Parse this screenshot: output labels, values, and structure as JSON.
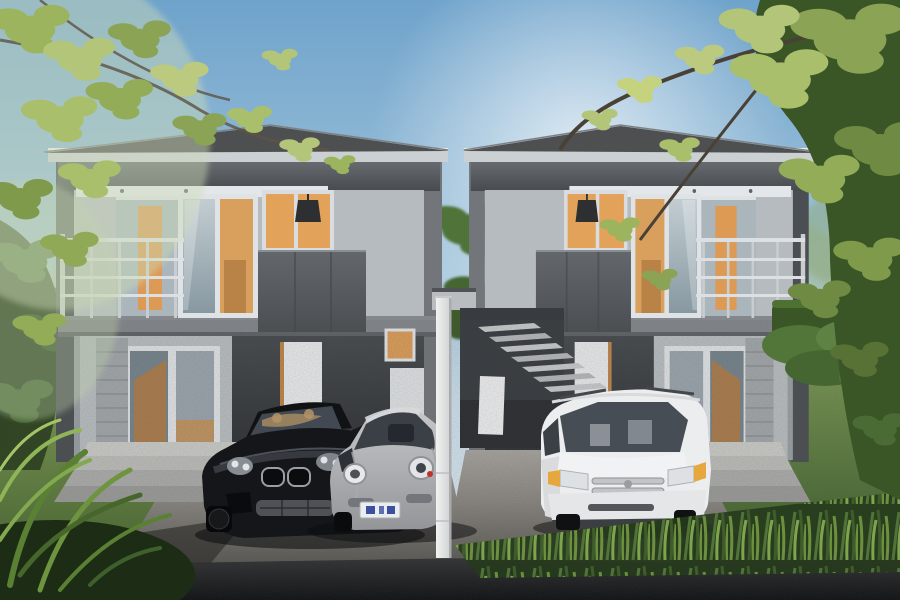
{
  "scene": {
    "title": "Twin modern two-storey houses - exterior 3D render",
    "description": "Photorealistic architectural rendering of two matching grey two-storey houses with balconies and warm orange-lit interiors, an outdoor concrete staircase between the units, a black sports coupe and a silver sports coupe parked in the left gravel driveway, a white minivan in the right driveway, landscaped lawns with hedges and ferns, overhanging yellow-green tree branches, and a dark asphalt road in the foreground under a hazy blue sky.",
    "objects": {
      "sky": "clear blue sky with soft central haze",
      "left_house": "grey two-storey house, left unit, balcony on left, carport below",
      "right_house": "grey two-storey house, right unit, mirrored layout",
      "center_staircase": "outdoor concrete stair between the two units",
      "divider_post": "tall white post between the driveways",
      "black_coupe": "black open-top sports coupe with twin-kidney grille",
      "silver_coupe": "silver sports coupe with round headlights",
      "white_minivan": "white minivan with roof rails and amber corner lights",
      "license_plate": "small white plate with blue characters (illegible)",
      "left_driveway": "gravel driveway in front of left unit",
      "right_driveway": "gravel driveway in front of right unit",
      "front_road": "dark asphalt road strip across the bottom",
      "landscaping": "lawns, trimmed hedges, ferns, tall grass and overhanging branches"
    }
  },
  "palette": {
    "sky_top": "#6fa3cb",
    "sky_horizon": "#ddeaf2",
    "roof": "#4d4f51",
    "fascia": "#cbd0d3",
    "wall_light": "#b6bbbf",
    "wall_mid": "#9aa0a4",
    "panel_charcoal": "#34383c",
    "interior_orange": "#d89f5d",
    "glass_blue": "#aab6bc",
    "railing": "#dde0e2",
    "lawn_light": "#90ad63",
    "lawn_dark": "#3c5c2b",
    "foliage_dark": "#33501f",
    "leaf_yellow_green": "#b3c578",
    "paver": "#bdbeba",
    "gravel": "#8a8781",
    "road": "#1a1c1e",
    "car_black": "#14161a",
    "car_silver": "#c6c8ca",
    "van_white": "#ebedee",
    "plate_blue": "#3c50a0",
    "amber_marker": "#e6a83d"
  }
}
